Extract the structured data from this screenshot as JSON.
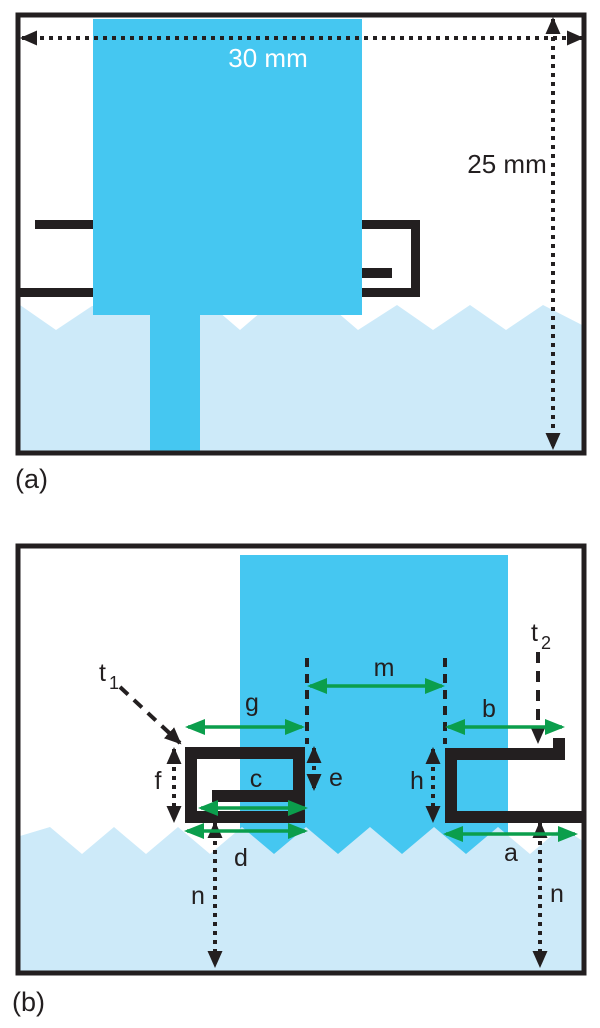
{
  "colors": {
    "patch": "#45C7F1",
    "ground": "#CDEAF9",
    "ink": "#231F20",
    "green": "#0B9E4C"
  },
  "panel_a": {
    "caption": "(a)",
    "width_label": "30 mm",
    "height_label": "25 mm"
  },
  "panel_b": {
    "caption": "(b)",
    "labels": {
      "a": "a",
      "b": "b",
      "c": "c",
      "d": "d",
      "e": "e",
      "f": "f",
      "g": "g",
      "h": "h",
      "m": "m",
      "n_left": "n",
      "n_right": "n",
      "t1_base": "t",
      "t1_sub": "1",
      "t2_base": "t",
      "t2_sub": "2"
    }
  }
}
